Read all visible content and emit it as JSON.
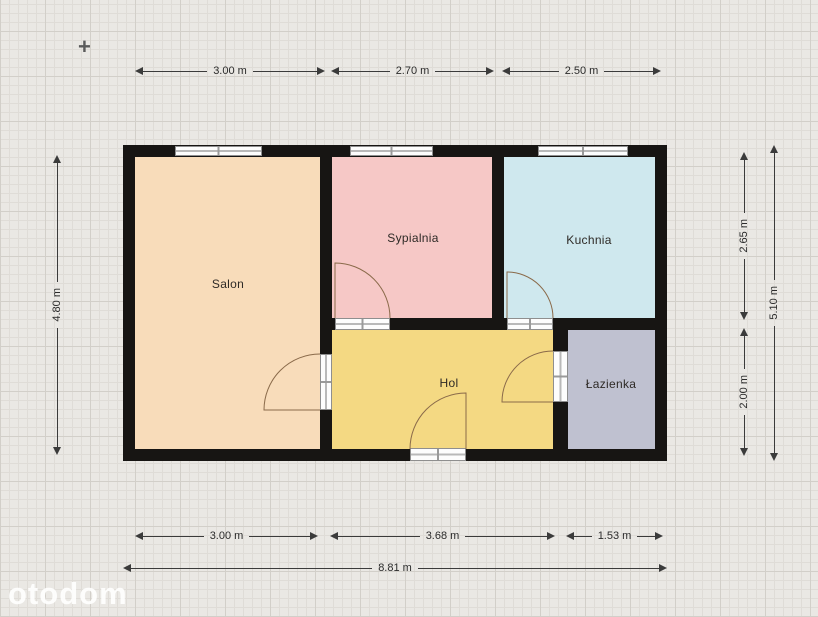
{
  "marker": {
    "glyph": "+"
  },
  "watermark": {
    "text": "otodom"
  },
  "plan": {
    "rooms": [
      {
        "label": "Salon",
        "color": "#f8dcba"
      },
      {
        "label": "Sypialnia",
        "color": "#f6c8c6"
      },
      {
        "label": "Kuchnia",
        "color": "#cfe8ee"
      },
      {
        "label": "Hol",
        "color": "#f4d983"
      },
      {
        "label": "Łazienka",
        "color": "#bfc1d0"
      }
    ],
    "colors": {
      "wall": "#171513",
      "background": "#eae8e4",
      "dimension_line": "#3b3b3b",
      "door_arc": "#8a6a4a",
      "window_frame": "#fdfdfd"
    },
    "dimensions": {
      "top": [
        "3.00 m",
        "2.70 m",
        "2.50 m"
      ],
      "left": [
        "4.80 m"
      ],
      "right_inner": [
        "2.65 m",
        "2.00 m"
      ],
      "right_outer": [
        "5.10 m"
      ],
      "bottom": [
        "3.00 m",
        "3.68 m",
        "1.53 m"
      ],
      "bottom_total": [
        "8.81 m"
      ]
    }
  }
}
